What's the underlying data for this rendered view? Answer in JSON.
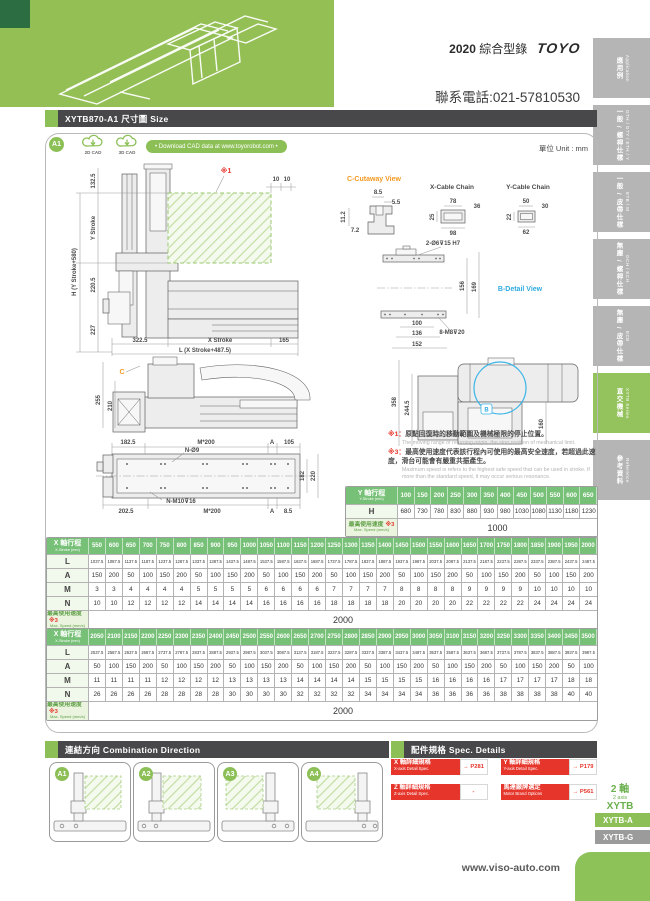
{
  "header": {
    "year": "2020",
    "catalog": "綜合型錄",
    "logo": "TOYO",
    "phone": "聯系電話:021-57810530"
  },
  "sidebar": {
    "tabs": [
      {
        "zh": "應用例",
        "en": "Application",
        "active": false
      },
      {
        "zh": "一般 / 螺桿仕樣",
        "en": "GTH / GTY / ETH / Y",
        "active": false
      },
      {
        "zh": "一般 / 皮帶仕樣",
        "en": "ETB / M",
        "active": false
      },
      {
        "zh": "無塵 / 螺桿仕樣",
        "en": "GCH / ECH",
        "active": false
      },
      {
        "zh": "無塵 / 皮帶仕樣",
        "en": "ECB",
        "active": false
      },
      {
        "zh": "直交機械",
        "en": "XYTB Series",
        "active": true
      },
      {
        "zh": "參考資料",
        "en": "Reference",
        "active": false
      }
    ]
  },
  "title_bar": {
    "text": "XYTB870-A1 尺寸圖 Size"
  },
  "panel": {
    "badge": "A1",
    "cad_2d": "2D CAD",
    "cad_3d": "3D CAD",
    "download": "• Download CAD data at www.toyorobot.com •",
    "unit": "單位 Unit : mm"
  },
  "drawing": {
    "front": {
      "ref": "※1",
      "off1": "10",
      "off2": "10",
      "h": "H (Y Stroke+580)",
      "ys": "Y Stroke",
      "d1": "132.5",
      "d2": "220.5",
      "d3": "227",
      "b1": "322.5",
      "bx": "X Stroke",
      "b2": "165",
      "bl": "L (X Stroke+487.5)"
    },
    "cutaway": {
      "label": "C-Cutaway View",
      "d1": "8.5",
      "d2": "5.5",
      "d3": "11.2",
      "d4": "7.2"
    },
    "x_chain": {
      "label": "X-Cable Chain",
      "d1": "78",
      "d2": "36",
      "d3": "25",
      "d4": "98"
    },
    "y_chain": {
      "label": "Y-Cable Chain",
      "d1": "50",
      "d2": "30",
      "d3": "22",
      "d4": "62"
    },
    "b_detail": {
      "label": "B-Detail View",
      "top": "2-Ø6⊽15 H7",
      "d1": "156",
      "d2": "169",
      "d3": "100",
      "d4": "136",
      "d5": "152",
      "bot": "8-M8⊽20",
      "bref": "B"
    },
    "side": {
      "d1": "255",
      "d2": "210",
      "cref": "C"
    },
    "side2": {
      "d1": "358",
      "d2": "244.5",
      "d3": "160"
    },
    "plan": {
      "d1": "182.5",
      "m1": "M*200",
      "a1": "A",
      "d2": "105",
      "nh": "N-Ø9",
      "d3": "182",
      "d4": "220",
      "d5": "202.5",
      "nm": "N-M10⊽16",
      "m2": "M*200",
      "a2": "A",
      "d6": "8.5"
    }
  },
  "notes": {
    "n1_ref": "※1：",
    "n1_zh": "原點回復時的移動範圍及機械極限的停止位置。",
    "n1_en": "The moving range of returning origin, the stop position of mechanical limit.",
    "n3_ref": "※3：",
    "n3_zh": "最高使用速度代表該行程內可使用的最高安全速度，若超過此速度，滑台可能會有嚴重共振產生。",
    "n3_en": "Maximum speed is refers to the highest safe speed that can be used in stroke. If more than the standard speed, it may occur serious resonance."
  },
  "y_table": {
    "label_zh": "Y 軸行程",
    "label_en": "Y-Stroke (mm)",
    "label_w": 52,
    "strokes": [
      "100",
      "150",
      "200",
      "250",
      "300",
      "350",
      "400",
      "450",
      "500",
      "550",
      "600",
      "650"
    ],
    "rows": [
      {
        "label": "H",
        "small": false,
        "values": [
          "680",
          "730",
          "780",
          "830",
          "880",
          "930",
          "980",
          "1030",
          "1080",
          "1130",
          "1180",
          "1230"
        ]
      }
    ],
    "speed_zh": "最高使用速度",
    "speed_ref": "※3",
    "speed_en": "Max. Speed (mm/s)",
    "speed": "1000"
  },
  "x_table_1": {
    "label_zh": "X 軸行程",
    "label_en": "X-Stroke (mm)",
    "label_w": 42,
    "strokes": [
      "550",
      "600",
      "650",
      "700",
      "750",
      "800",
      "850",
      "900",
      "950",
      "1000",
      "1050",
      "1100",
      "1150",
      "1200",
      "1250",
      "1300",
      "1350",
      "1400",
      "1450",
      "1500",
      "1550",
      "1600",
      "1650",
      "1700",
      "1750",
      "1800",
      "1850",
      "1900",
      "1950",
      "2000"
    ],
    "rows": [
      {
        "label": "L",
        "small": true,
        "values": [
          "1037.5",
          "1087.5",
          "1137.5",
          "1187.5",
          "1237.5",
          "1287.5",
          "1337.5",
          "1387.5",
          "1437.5",
          "1487.5",
          "1537.5",
          "1587.5",
          "1637.5",
          "1687.5",
          "1737.5",
          "1787.5",
          "1837.5",
          "1887.5",
          "1937.5",
          "1987.5",
          "2037.5",
          "2087.5",
          "2137.5",
          "2187.5",
          "2237.5",
          "2287.5",
          "2337.5",
          "2387.5",
          "2437.5",
          "2487.5"
        ]
      },
      {
        "label": "A",
        "small": false,
        "values": [
          "150",
          "200",
          "50",
          "100",
          "150",
          "200",
          "50",
          "100",
          "150",
          "200",
          "50",
          "100",
          "150",
          "200",
          "50",
          "100",
          "150",
          "200",
          "50",
          "100",
          "150",
          "200",
          "50",
          "100",
          "150",
          "200",
          "50",
          "100",
          "150",
          "200"
        ]
      },
      {
        "label": "M",
        "small": false,
        "values": [
          "3",
          "3",
          "4",
          "4",
          "4",
          "4",
          "5",
          "5",
          "5",
          "5",
          "6",
          "6",
          "6",
          "6",
          "7",
          "7",
          "7",
          "7",
          "8",
          "8",
          "8",
          "8",
          "9",
          "9",
          "9",
          "9",
          "10",
          "10",
          "10",
          "10"
        ]
      },
      {
        "label": "N",
        "small": false,
        "values": [
          "10",
          "10",
          "12",
          "12",
          "12",
          "12",
          "14",
          "14",
          "14",
          "14",
          "16",
          "16",
          "16",
          "16",
          "18",
          "18",
          "18",
          "18",
          "20",
          "20",
          "20",
          "20",
          "22",
          "22",
          "22",
          "22",
          "24",
          "24",
          "24",
          "24"
        ]
      }
    ],
    "speed_zh": "最高使用速度",
    "speed_ref": "※3",
    "speed_en": "Max. Speed (mm/s)",
    "speed": "2000"
  },
  "x_table_2": {
    "label_zh": "X 軸行程",
    "label_en": "X-Stroke (mm)",
    "label_w": 42,
    "strokes": [
      "2050",
      "2100",
      "2150",
      "2200",
      "2250",
      "2300",
      "2350",
      "2400",
      "2450",
      "2500",
      "2550",
      "2600",
      "2650",
      "2700",
      "2750",
      "2800",
      "2850",
      "2900",
      "2950",
      "3000",
      "3050",
      "3100",
      "3150",
      "3200",
      "3250",
      "3300",
      "3350",
      "3400",
      "3450",
      "3500"
    ],
    "rows": [
      {
        "label": "L",
        "small": true,
        "values": [
          "2537.5",
          "2587.5",
          "2637.5",
          "2687.5",
          "2737.5",
          "2787.5",
          "2837.5",
          "2887.5",
          "2937.5",
          "2987.5",
          "3037.5",
          "3087.5",
          "3137.5",
          "3187.5",
          "3237.5",
          "3287.5",
          "3337.5",
          "3387.5",
          "3437.5",
          "3487.5",
          "3537.5",
          "3587.5",
          "3637.5",
          "3687.5",
          "3737.5",
          "3787.5",
          "3837.5",
          "3887.5",
          "3937.5",
          "3987.5"
        ]
      },
      {
        "label": "A",
        "small": false,
        "values": [
          "50",
          "100",
          "150",
          "200",
          "50",
          "100",
          "150",
          "200",
          "50",
          "100",
          "150",
          "200",
          "50",
          "100",
          "150",
          "200",
          "50",
          "100",
          "150",
          "200",
          "50",
          "100",
          "150",
          "200",
          "50",
          "100",
          "150",
          "200",
          "50",
          "100"
        ]
      },
      {
        "label": "M",
        "small": false,
        "values": [
          "11",
          "11",
          "11",
          "11",
          "12",
          "12",
          "12",
          "12",
          "13",
          "13",
          "13",
          "13",
          "14",
          "14",
          "14",
          "14",
          "15",
          "15",
          "15",
          "15",
          "16",
          "16",
          "16",
          "16",
          "17",
          "17",
          "17",
          "17",
          "18",
          "18"
        ]
      },
      {
        "label": "N",
        "small": false,
        "values": [
          "26",
          "26",
          "26",
          "26",
          "28",
          "28",
          "28",
          "28",
          "30",
          "30",
          "30",
          "30",
          "32",
          "32",
          "32",
          "32",
          "34",
          "34",
          "34",
          "34",
          "36",
          "36",
          "36",
          "36",
          "38",
          "38",
          "38",
          "38",
          "40",
          "40"
        ]
      }
    ],
    "speed_zh": "最高使用速度",
    "speed_ref": "※3",
    "speed_en": "Max. Speed (mm/s)",
    "speed": "2000"
  },
  "combination": {
    "title_zh": "連結方向",
    "title_en": "Combination Direction",
    "items": [
      "A1",
      "A2",
      "A3",
      "A4"
    ]
  },
  "spec_details": {
    "title_zh": "配件規格",
    "title_en": "Spec. Details",
    "chips": [
      {
        "zh": "X 軸詳細規格",
        "en": "X-axis Detail Spec.",
        "page": "→ P281"
      },
      {
        "zh": "Y 軸詳細規格",
        "en": "Y-axis Detail Spec.",
        "page": "→ P179"
      },
      {
        "zh": "Z 軸詳細規格",
        "en": "Z-axis Detail Spec.",
        "page": "-"
      },
      {
        "zh": "馬達廠牌選定",
        "en": "Motor Brand Options",
        "page": "→ P561"
      }
    ]
  },
  "series_box": {
    "axis_zh": "2 軸",
    "axis_en": "2 axis",
    "series": "XYTB",
    "tabs": [
      "XYTB-A",
      "XYTB-G"
    ]
  },
  "footer": {
    "website": "www.viso-auto.com"
  },
  "colors": {
    "accent_green": "#8cc057",
    "table_green": "#77c077",
    "chip_red": "#e6352b",
    "bar_dark": "#48484a",
    "label_orange": "#f59a23",
    "label_cyan": "#2fabe1"
  }
}
